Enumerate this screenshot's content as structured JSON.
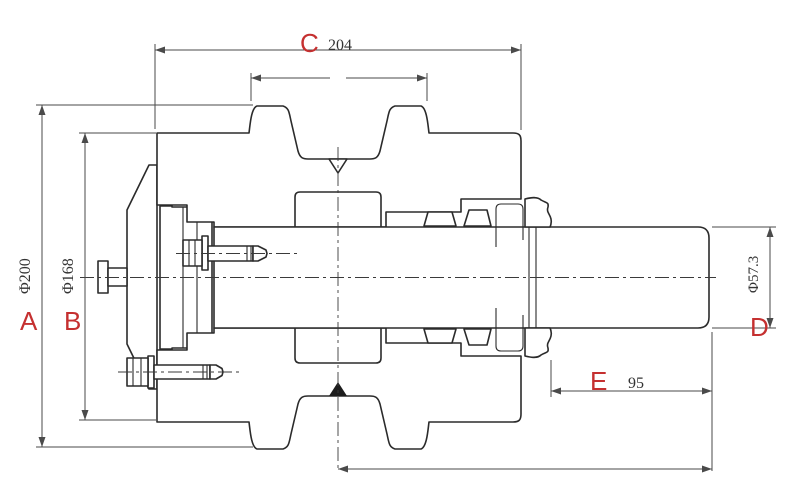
{
  "drawing": {
    "type": "track-roller-cross-section",
    "dims": {
      "A": {
        "letter": "A",
        "value": "Φ200"
      },
      "B": {
        "letter": "B",
        "value": "Φ168"
      },
      "C": {
        "letter": "C",
        "value": "204"
      },
      "D": {
        "letter": "D",
        "value": "Φ57.3"
      },
      "E": {
        "letter": "E",
        "value": "95"
      }
    },
    "colors": {
      "accent": "#c53030",
      "line": "#2b2b2b",
      "dim_line": "#4a4a4a"
    }
  }
}
